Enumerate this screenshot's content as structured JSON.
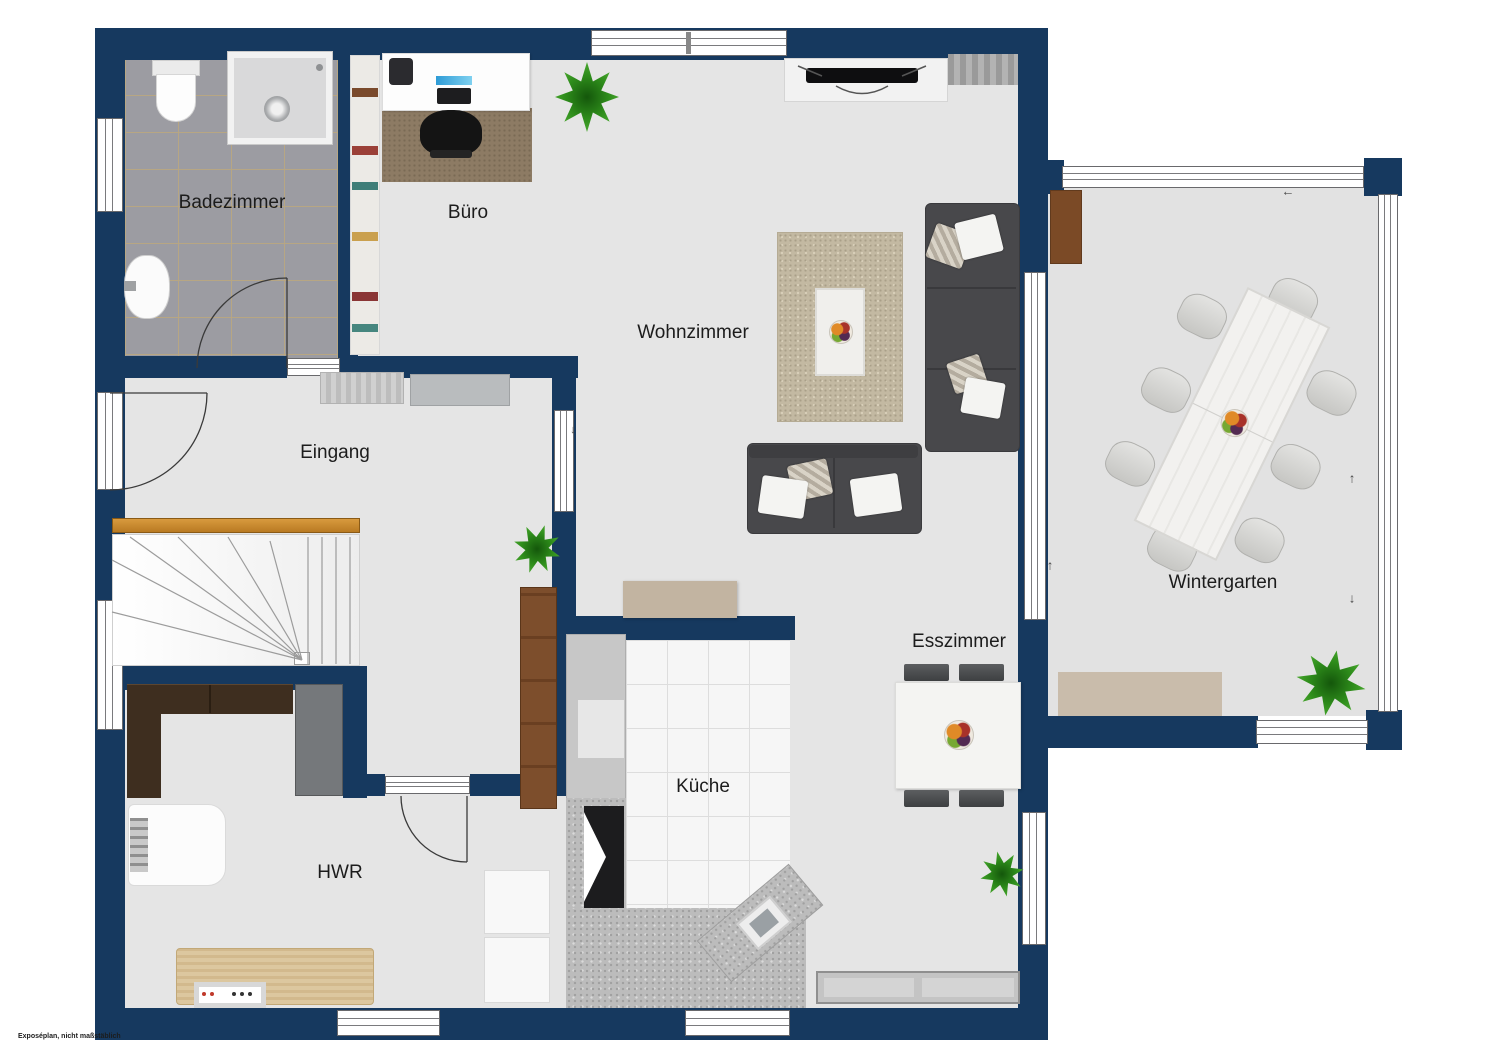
{
  "footer_note": "Exposéplan, nicht maßstäblich",
  "labels": {
    "badezimmer": "Badezimmer",
    "buero": "Büro",
    "wohnzimmer": "Wohnzimmer",
    "eingang": "Eingang",
    "wintergarten": "Wintergarten",
    "esszimmer": "Esszimmer",
    "kueche": "Küche",
    "hwr": "HWR"
  },
  "arrows": {
    "left": "←",
    "up": "↑",
    "down": "↓"
  },
  "colors": {
    "wall": "#16395f",
    "floor": "#e5e5e5",
    "bath_tile": "#9c9ca2",
    "kitchen_tile": "#f6f6f6",
    "granite_counter": "#bcbcbc",
    "handrail_wood": "#c8862f",
    "sofa_gray": "#48484b",
    "living_rug": "#c3b9a2",
    "office_rug": "#8d7b64",
    "sideboard_beige": "#c2b4a1",
    "plant_green": "#2e8c1b"
  },
  "furniture_icons": [
    "toilet",
    "shower",
    "bathroom-sink",
    "bookshelf",
    "desk",
    "office-phone",
    "monitor",
    "office-chair",
    "office-rug",
    "potted-plant",
    "tv-lowboard",
    "tv",
    "wall-shelf",
    "sofa-large",
    "sofa-small",
    "living-rug",
    "coffee-table",
    "fruit-bowl",
    "hall-sideboard",
    "staircase",
    "handrail",
    "wardrobe",
    "utility-cabinet",
    "washing-machine",
    "utility-table",
    "appliance",
    "kitchen-counter",
    "stove",
    "kitchen-sink",
    "dining-table",
    "dining-chair",
    "dining-sideboard",
    "conservatory-table",
    "conservatory-chair",
    "door-mat",
    "conservatory-cabinet"
  ]
}
